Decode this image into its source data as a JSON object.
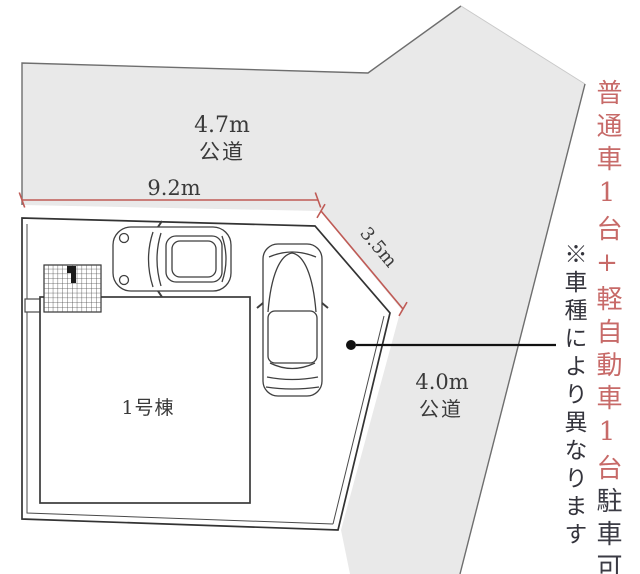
{
  "plan": {
    "roads": {
      "top": {
        "width": "4.7m",
        "type": "公道"
      },
      "right": {
        "width": "4.0m",
        "type": "公道"
      }
    },
    "dimensions": {
      "frontage": "9.2m",
      "corner": "3.5m"
    },
    "building": {
      "label": "1号棟"
    },
    "parking_note": {
      "highlight": "普通車1台+軽自動車1台",
      "suffix": "駐車可",
      "disclaimer": "※車種により異なります"
    },
    "colors": {
      "road_fill": "#e9e9e9",
      "dimension_red": "#bf5a55",
      "note_red": "#c76a68",
      "text_dark": "#3a3a3a"
    }
  }
}
